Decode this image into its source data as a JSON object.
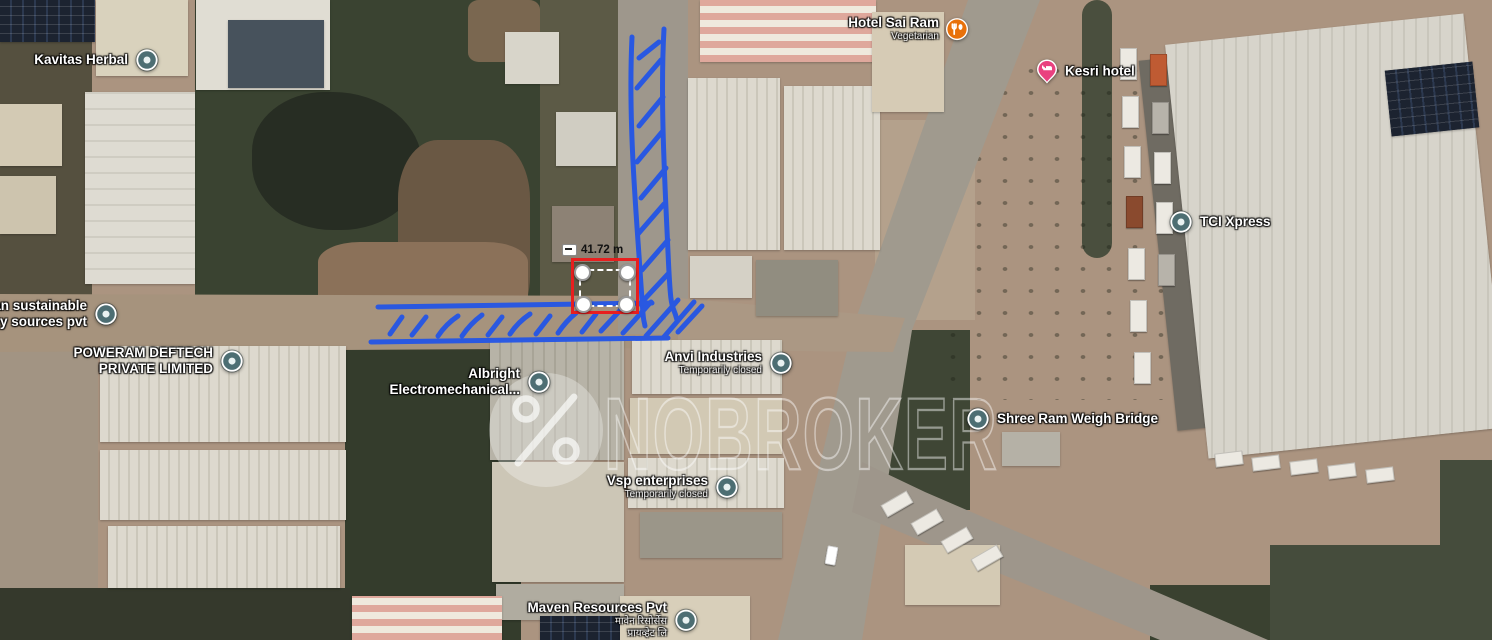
{
  "map": {
    "watermark": {
      "text": "NOBROKER",
      "logo_icon": "nobroker-percent-logo"
    },
    "measurement": {
      "value": "41.72 m",
      "plot_outline_color": "#e81f1f"
    },
    "annotation": {
      "color": "#2154e8"
    },
    "labels": [
      {
        "id": "kavitas-herbal",
        "icon": "poi",
        "icon_color": "#4d6e73",
        "icon_side": "right",
        "x": 147,
        "y": 60,
        "lines": [
          {
            "t": "Kavitas Herbal"
          }
        ]
      },
      {
        "id": "hotel-sai-ram",
        "icon": "restaurant",
        "icon_color": "#e8710a",
        "icon_side": "right",
        "x": 956,
        "y": 29,
        "lines": [
          {
            "t": "Hotel Sai Ram"
          },
          {
            "t": "Vegetarian",
            "small": true
          }
        ]
      },
      {
        "id": "kesri-hotel",
        "icon": "hotel-pin",
        "icon_color": "#e9417f",
        "icon_side": "left",
        "x": 1048,
        "y": 71,
        "lines": [
          {
            "t": "Kesri hotel"
          }
        ]
      },
      {
        "id": "tci-xpress",
        "icon": "poi",
        "icon_color": "#4d6e73",
        "icon_side": "left",
        "x": 1181,
        "y": 222,
        "lines": [
          {
            "t": "TCI Xpress"
          }
        ]
      },
      {
        "id": "urban-sustainable-energy",
        "icon": "poi",
        "icon_color": "#4d6e73",
        "icon_side": "right",
        "x": 106,
        "y": 314,
        "lines": [
          {
            "t": "Urban sustainable"
          },
          {
            "t": "energy sources pvt"
          }
        ]
      },
      {
        "id": "poweram-deftech",
        "icon": "poi",
        "icon_color": "#4d6e73",
        "icon_side": "right",
        "x": 232,
        "y": 361,
        "lines": [
          {
            "t": "POWERAM DEFTECH"
          },
          {
            "t": "PRIVATE LIMITED"
          }
        ]
      },
      {
        "id": "albright-electromechanical",
        "icon": "poi",
        "icon_color": "#4d6e73",
        "icon_side": "right",
        "x": 539,
        "y": 382,
        "lines": [
          {
            "t": "Albright"
          },
          {
            "t": "Electromechanical..."
          }
        ]
      },
      {
        "id": "anvi-industries",
        "icon": "poi",
        "icon_color": "#4d6e73",
        "icon_side": "right",
        "x": 781,
        "y": 363,
        "lines": [
          {
            "t": "Anvi Industries"
          },
          {
            "t": "Temporarily closed",
            "small": true
          }
        ]
      },
      {
        "id": "shree-ram-weigh-bridge",
        "icon": "poi",
        "icon_color": "#4d6e73",
        "icon_side": "left",
        "x": 978,
        "y": 419,
        "lines": [
          {
            "t": "Shree Ram Weigh Bridge"
          }
        ]
      },
      {
        "id": "vsp-enterprises",
        "icon": "poi",
        "icon_color": "#4d6e73",
        "icon_side": "right",
        "x": 727,
        "y": 487,
        "lines": [
          {
            "t": "Vsp enterprises"
          },
          {
            "t": "Temporarily closed",
            "small": true
          }
        ]
      },
      {
        "id": "maven-resources",
        "icon": "poi",
        "icon_color": "#4d6e73",
        "icon_side": "right",
        "x": 686,
        "y": 620,
        "lines": [
          {
            "t": "Maven Resources Pvt"
          },
          {
            "t": "मावेन रिसोर्सेस",
            "small": true
          },
          {
            "t": "प्रायव्हेट लि",
            "small": true
          }
        ]
      }
    ]
  }
}
